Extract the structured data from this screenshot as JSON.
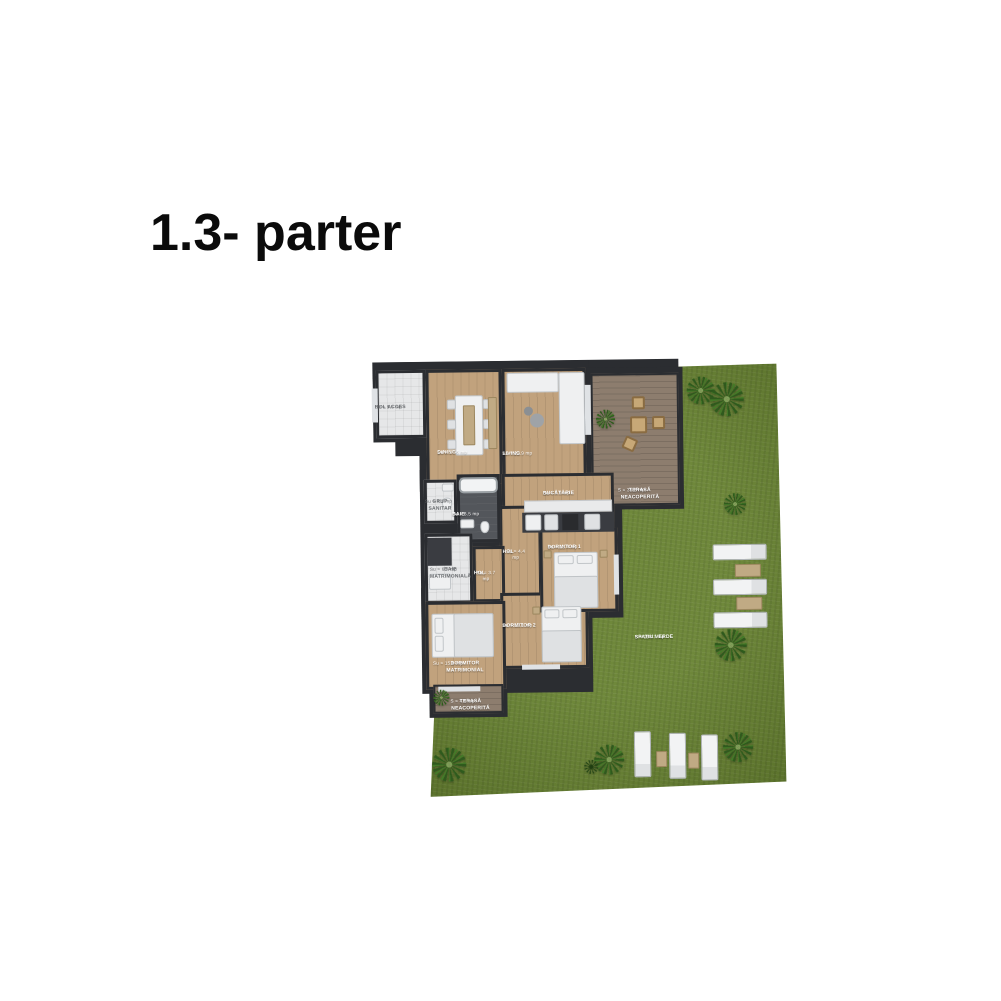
{
  "page": {
    "title": "1.3- parter",
    "background": "#ffffff"
  },
  "plan": {
    "colors": {
      "wall": "#2b2d31",
      "wood_floor": "#c1a27d",
      "deck_floor": "#8d7d6e",
      "grass": "#66812f",
      "tile_floor": "#e6e7e8",
      "dark_floor": "#53565b"
    },
    "rooms": [
      {
        "name": "HOL ACCES",
        "area": "Su = 5.5 mp"
      },
      {
        "name": "DINING",
        "area": "Su = 17.6 mp"
      },
      {
        "name": "LIVING",
        "area": "Su = 22.9 mp"
      },
      {
        "name": "GRUP SANITAR",
        "area": "Su = 4.1 mp"
      },
      {
        "name": "BAIE",
        "area": "Su = 6.5 mp"
      },
      {
        "name": "BUCĂTĂRIE",
        "area": "Su = 9.9 mp"
      },
      {
        "name": "HOL",
        "area": "Su = 4.4 mp"
      },
      {
        "name": "DORMITOR 1",
        "area": "Su = 13.4 mp"
      },
      {
        "name": "BAIE MATRIMONIALĂ",
        "area": "Su = 6.7 mp"
      },
      {
        "name": "HOL",
        "area": "Su = 3.7 mp"
      },
      {
        "name": "DORMITOR 2",
        "area": "Su = 13.1 mp"
      },
      {
        "name": "DORMITOR MATRIMONIAL",
        "area": "Su = 15.8 mp"
      }
    ],
    "terraces": [
      {
        "name": "TERASĂ NEACOPERITĂ",
        "area": "S = 35.8 mp"
      },
      {
        "name": "TERASĂ NEACOPERITĂ",
        "area": "S = 4.6 mp"
      }
    ],
    "garden": {
      "name": "SPATIU VERDE",
      "area": "S = 198.3 mp"
    }
  }
}
